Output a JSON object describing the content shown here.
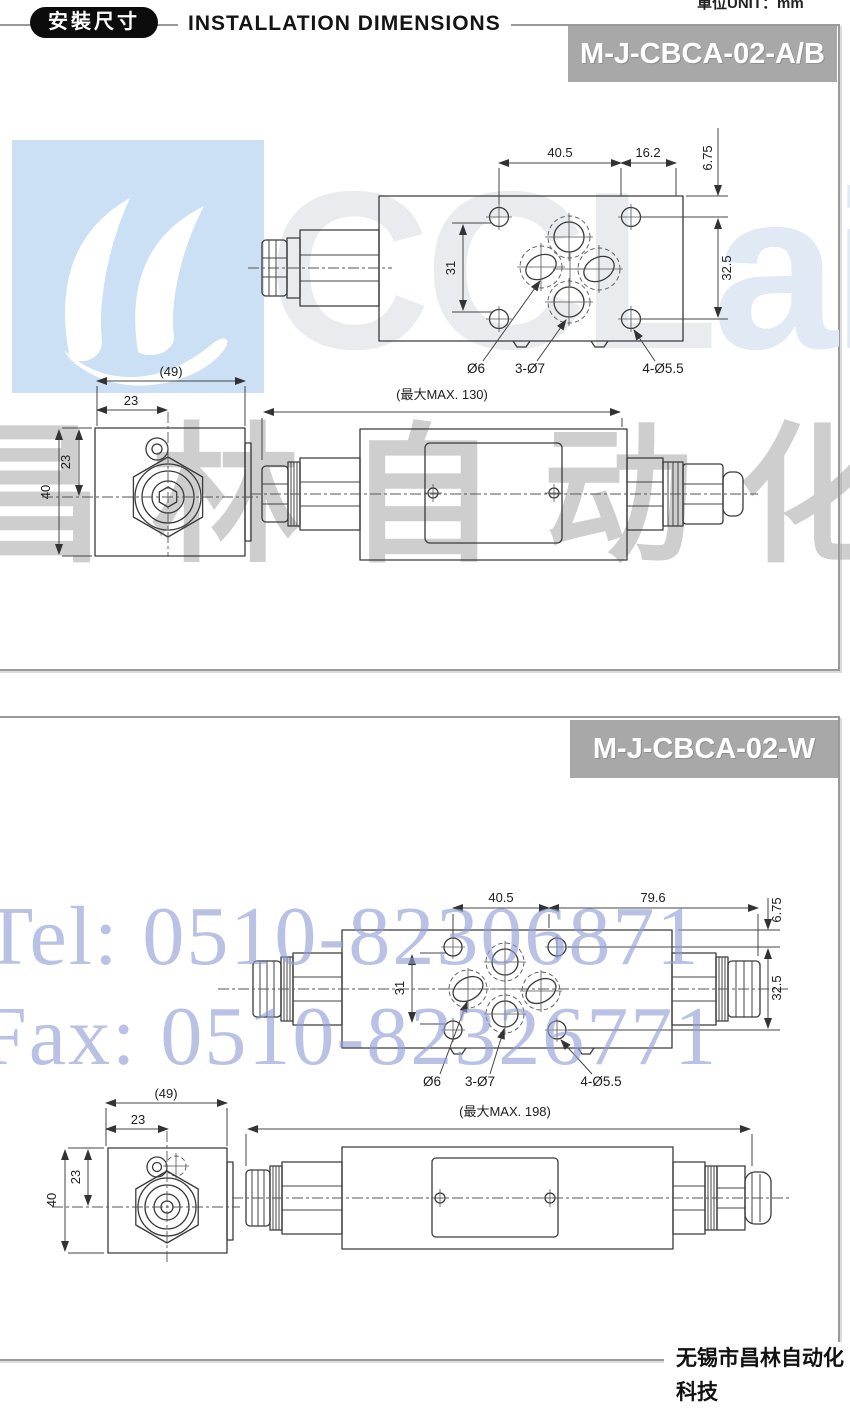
{
  "page": {
    "unit_label": "單位UNIT：mm",
    "header": {
      "badge": "安裝尺寸",
      "title": "INSTALLATION DIMENSIONS"
    },
    "footer": "无锡市昌林自动化科技",
    "colors": {
      "banner_gray": "#a8a8a8",
      "logo_blue": "#cbe0f4",
      "watermark_blue": "#8f9cd6",
      "watermark_gray": "#9e9e9e"
    }
  },
  "watermark": {
    "logo_prefix": "CCL",
    "logo_suffix": "air",
    "company_cn": "昌林自动化",
    "tel": "Tel: 0510-82306871",
    "fax": "Fax: 0510-82326771"
  },
  "panels": [
    {
      "model": "M-J-CBCA-02-A/B",
      "top_view": {
        "dim_w1": "40.5",
        "dim_w2": "16.2",
        "dim_edge": "6.75",
        "dim_ports": "31",
        "dim_bolts": "32.5",
        "label_port": "Ø6",
        "label_ports": "3-Ø7",
        "label_bolts": "4-Ø5.5"
      },
      "end_view": {
        "dim_width": "(49)",
        "dim_offset_h": "23",
        "dim_offset_v": "23",
        "dim_height": "40"
      },
      "side_view": {
        "dim_max": "(最大MAX. 130)"
      }
    },
    {
      "model": "M-J-CBCA-02-W",
      "top_view": {
        "dim_w1": "40.5",
        "dim_w2": "79.6",
        "dim_edge": "6.75",
        "dim_ports": "31",
        "dim_bolts": "32.5",
        "label_port": "Ø6",
        "label_ports": "3-Ø7",
        "label_bolts": "4-Ø5.5"
      },
      "end_view": {
        "dim_width": "(49)",
        "dim_offset_h": "23",
        "dim_offset_v": "23",
        "dim_height": "40"
      },
      "side_view": {
        "dim_max": "(最大MAX. 198)"
      }
    }
  ]
}
